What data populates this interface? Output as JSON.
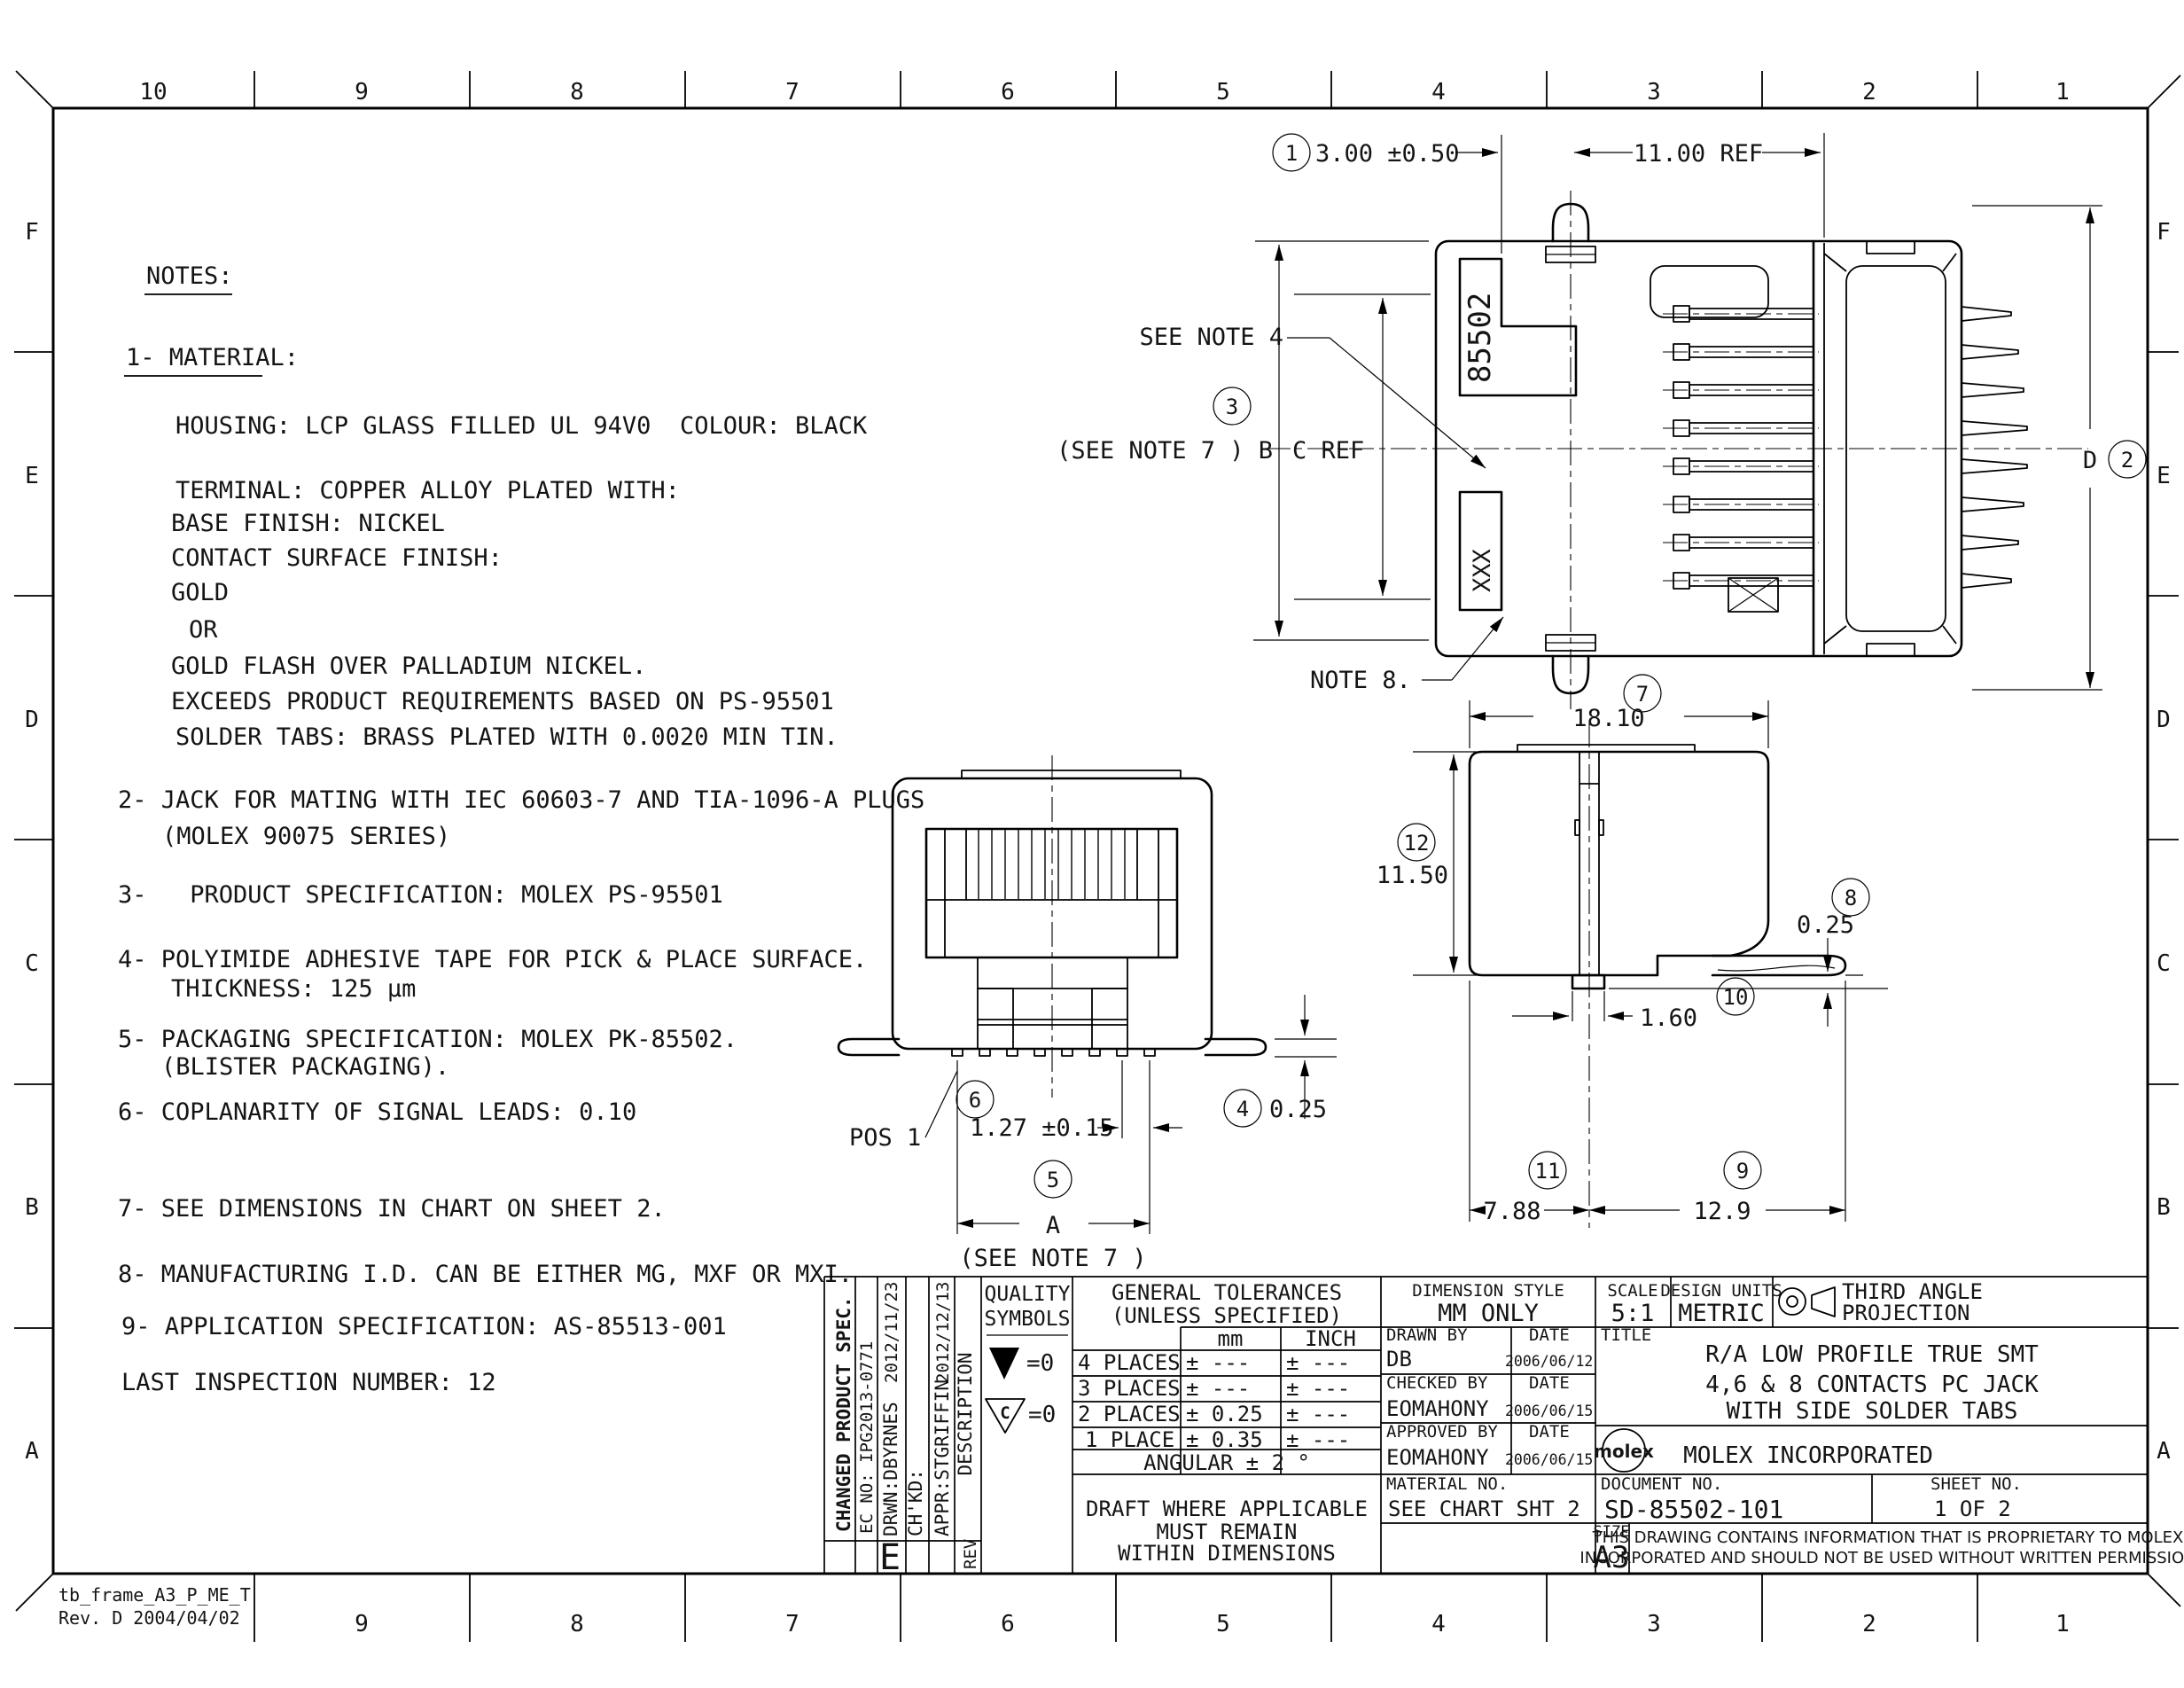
{
  "sheet": {
    "zones_top": [
      "10",
      "9",
      "8",
      "7",
      "6",
      "5",
      "4",
      "3",
      "2",
      "1"
    ],
    "zones_bottom": [
      "9",
      "8",
      "7",
      "6",
      "5",
      "4",
      "3",
      "2",
      "1"
    ],
    "rows": [
      "F",
      "E",
      "D",
      "C",
      "B",
      "A"
    ],
    "frame_name": "tb_frame_A3_P_ME_T",
    "frame_rev": "Rev. D 2004/04/02"
  },
  "notes": {
    "heading": "NOTES:",
    "material_heading": "1- MATERIAL:",
    "lines": [
      "HOUSING: LCP GLASS FILLED UL 94V0  COLOUR: BLACK",
      "TERMINAL: COPPER ALLOY PLATED WITH:",
      "BASE FINISH: NICKEL",
      "CONTACT SURFACE FINISH:",
      "GOLD",
      "OR",
      "GOLD FLASH OVER PALLADIUM NICKEL.",
      "EXCEEDS PRODUCT REQUIREMENTS BASED ON PS-95501",
      "SOLDER TABS: BRASS PLATED WITH 0.0020 MIN TIN.",
      "2- JACK FOR MATING WITH IEC 60603-7 AND TIA-1096-A PLUGS",
      "(MOLEX 90075 SERIES)",
      "3-   PRODUCT SPECIFICATION: MOLEX PS-95501",
      "4- POLYIMIDE ADHESIVE TAPE FOR PICK & PLACE SURFACE.",
      "THICKNESS: 125 μm",
      "5- PACKAGING SPECIFICATION: MOLEX PK-85502.",
      "(BLISTER PACKAGING).",
      "6- COPLANARITY OF SIGNAL LEADS: 0.10",
      "7- SEE DIMENSIONS IN CHART ON SHEET 2.",
      "8- MANUFACTURING I.D. CAN BE EITHER MG, MXF OR MXI.",
      "9- APPLICATION SPECIFICATION: AS-85513-001",
      "LAST INSPECTION NUMBER: 12"
    ]
  },
  "drawing": {
    "balloons": [
      "1",
      "2",
      "3",
      "4",
      "5",
      "6",
      "7",
      "8",
      "9",
      "10",
      "11",
      "12"
    ],
    "dim_3_00": "3.00 ±0.50",
    "dim_11_00": "11.00 REF",
    "see_note_4": "SEE NOTE 4",
    "b_label": "(SEE NOTE 7 ) B",
    "c_ref": "C REF",
    "d_label": "D",
    "note_8": "NOTE 8.",
    "marking_85502": "85502",
    "marking_xxx": "XXX",
    "pos_1": "POS 1",
    "dim_1_27": "1.27 ±0.15",
    "a_label": "A",
    "see_note_7": "(SEE NOTE 7 )",
    "dim_0_25_front": "0.25",
    "dim_18_10": "18.10",
    "dim_11_50": "11.50",
    "dim_0_25_side": "0.25",
    "dim_1_60": "1.60",
    "dim_7_88": "7.88",
    "dim_12_9": "12.9"
  },
  "title_block": {
    "revisions": {
      "changed": "CHANGED PRODUCT SPEC.",
      "ec_no": "EC NO: IPG2013-0771",
      "drwn": "DRWN:DBYRNES",
      "drwn_date": "2012/11/23",
      "chkd": "CH'KD:",
      "appr": "APPR:STGRIFFIN",
      "appr_date": "2012/12/13",
      "description": "DESCRIPTION",
      "rev": "REV",
      "rev_letter": "E"
    },
    "quality": {
      "line1": "QUALITY",
      "line2": "SYMBOLS",
      "eq1": "=0",
      "eq2": "=0",
      "c": "C"
    },
    "tolerances": {
      "heading1": "GENERAL TOLERANCES",
      "heading2": "(UNLESS SPECIFIED)",
      "col_mm": "mm",
      "col_inch": "INCH",
      "rows": [
        {
          "label": "4 PLACES",
          "mm": "± ---",
          "inch": "± ---"
        },
        {
          "label": "3 PLACES",
          "mm": "± ---",
          "inch": "± ---"
        },
        {
          "label": "2 PLACES",
          "mm": "± 0.25",
          "inch": "± ---"
        },
        {
          "label": "1 PLACE",
          "mm": "± 0.35",
          "inch": "± ---"
        }
      ],
      "angular": "ANGULAR ± 2 °",
      "draft1": "DRAFT WHERE APPLICABLE",
      "draft2": "MUST REMAIN",
      "draft3": "WITHIN DIMENSIONS"
    },
    "fields": {
      "dimension_style_label": "DIMENSION STYLE",
      "dimension_style": "MM ONLY",
      "scale_label": "SCALE",
      "scale": "5:1",
      "design_units_label": "DESIGN UNITS",
      "design_units": "METRIC",
      "projection1": "THIRD ANGLE",
      "projection2": "PROJECTION",
      "drawn_by_label": "DRAWN BY",
      "date_label": "DATE",
      "drawn_by": "DB",
      "drawn_date": "2006/06/12",
      "checked_by_label": "CHECKED BY",
      "checked_by": "EOMAHONY",
      "checked_date": "2006/06/15",
      "approved_by_label": "APPROVED BY",
      "approved_by": "EOMAHONY",
      "approved_date": "2006/06/15",
      "title_label": "TITLE",
      "title1": "R/A LOW PROFILE TRUE SMT",
      "title2": "4,6 & 8 CONTACTS PC JACK",
      "title3": "WITH SIDE SOLDER TABS",
      "logo": "molex",
      "company": "MOLEX INCORPORATED",
      "material_label": "MATERIAL NO.",
      "material": "SEE CHART SHT 2",
      "document_label": "DOCUMENT NO.",
      "document": "SD-85502-101",
      "sheet_label": "SHEET NO.",
      "sheet": "1 OF 2",
      "size_label": "SIZE",
      "size": "A3",
      "proprietary1": "THIS DRAWING CONTAINS INFORMATION THAT IS PROPRIETARY TO MOLEX",
      "proprietary2": "INCORPORATED AND SHOULD NOT BE USED WITHOUT WRITTEN PERMISSION"
    }
  }
}
